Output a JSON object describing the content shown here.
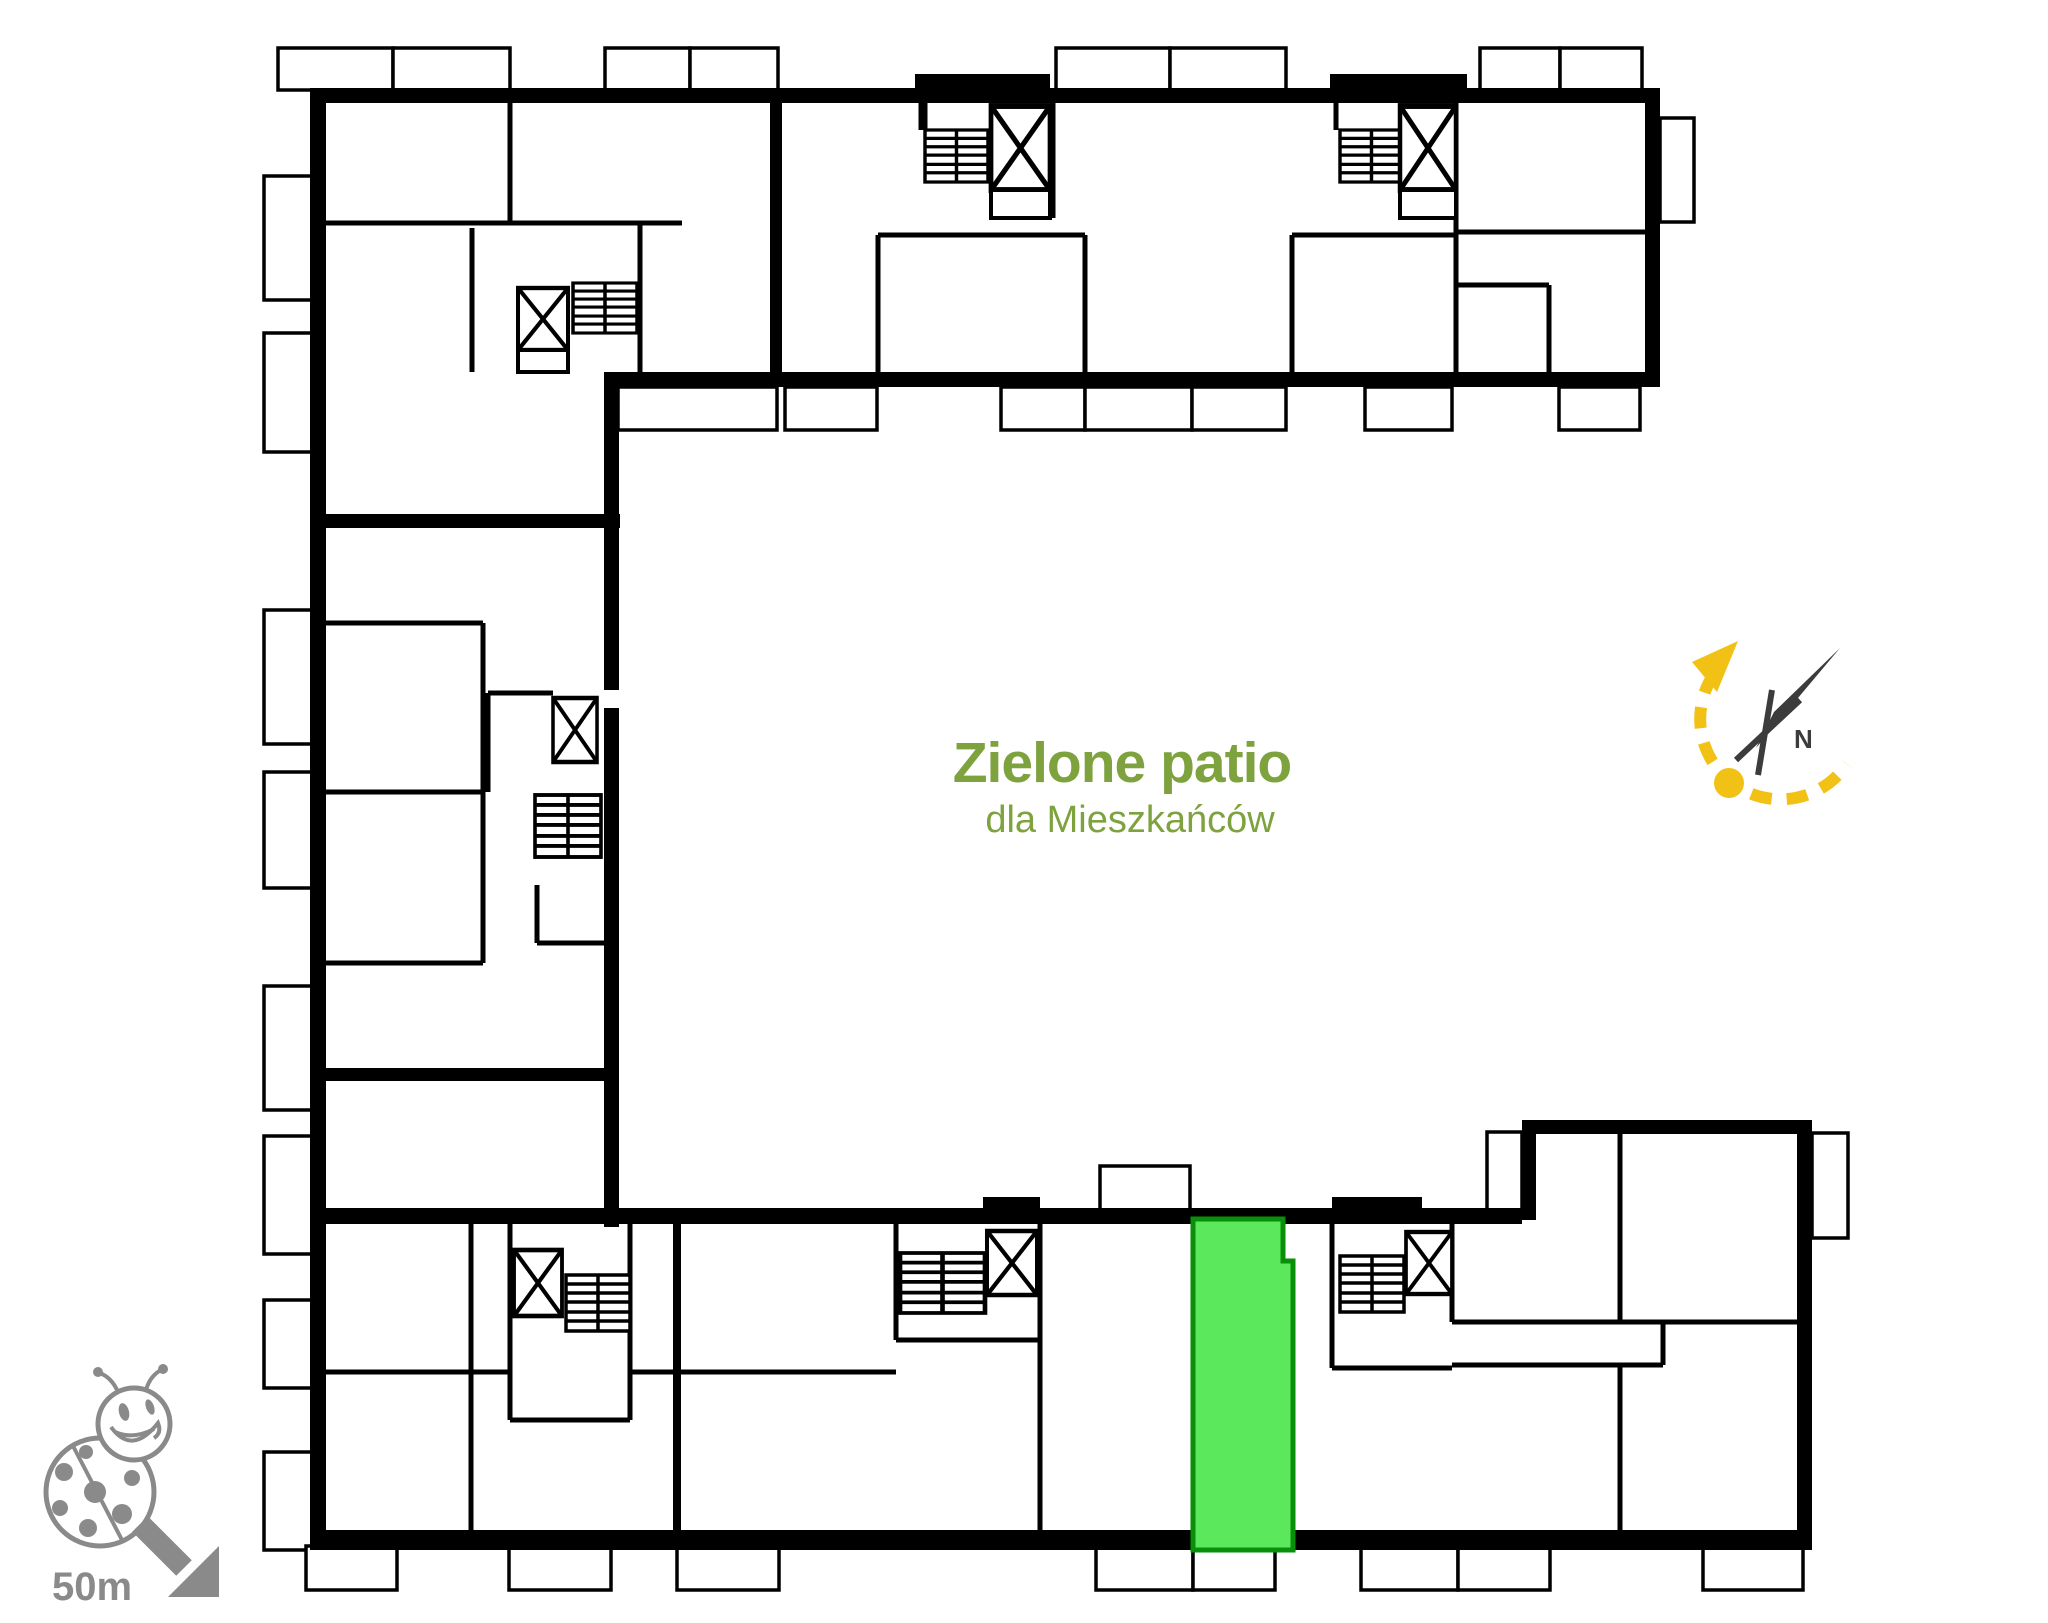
{
  "canvas": {
    "width": 2048,
    "height": 1623,
    "background": "#FFFFFF"
  },
  "courtyard": {
    "title": "Zielone patio",
    "subtitle": "dla Mieszkańców",
    "text_color": "#7DA23E"
  },
  "highlighted_unit": {
    "fill": "#5CE85C",
    "border_color": "#0A8F0A"
  },
  "compass": {
    "north_label": "N",
    "arc_color": "#F2C115",
    "needle_color": "#3C3C3C"
  },
  "scale_marker": {
    "label": "50m",
    "color": "#8A8A8A"
  },
  "plan": {
    "wall_color": "#000000",
    "icons": [
      "stairs-icon",
      "elevator-icon",
      "balcony",
      "ladybug-icon",
      "north-arrow-icon",
      "sun-path-arc-icon"
    ]
  }
}
